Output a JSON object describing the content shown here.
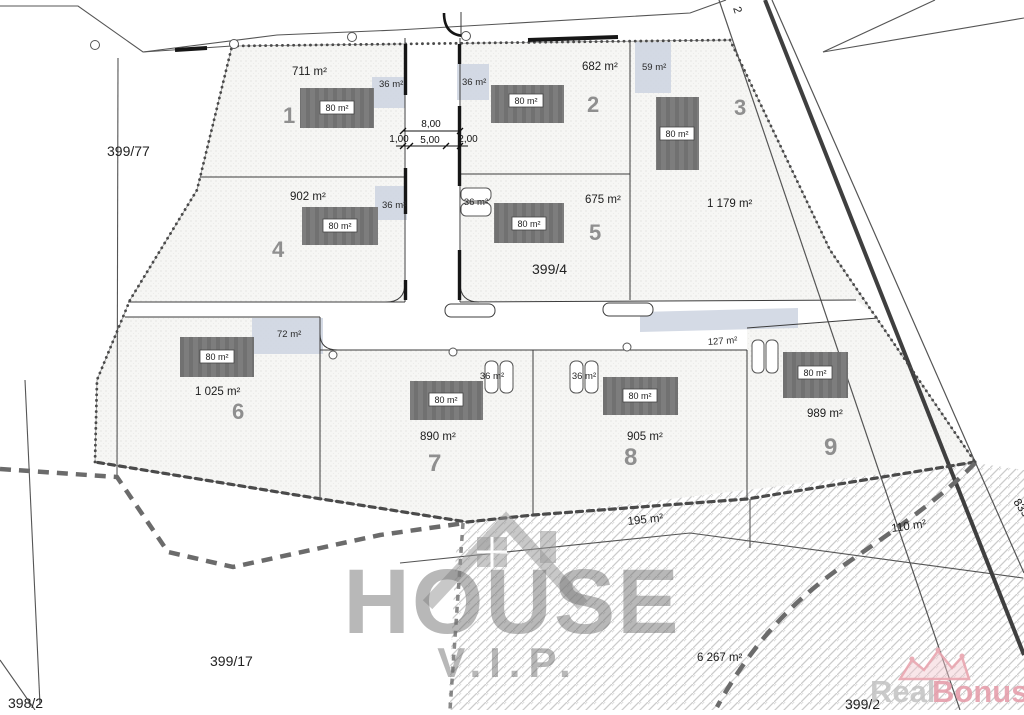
{
  "plan": {
    "plots": [
      {
        "number": "1",
        "area": "711 m²",
        "garage_area": "36 m²",
        "house_area": "80 m²"
      },
      {
        "number": "2",
        "area": "682 m²",
        "garage_area": "36 m²",
        "house_area": "80 m²"
      },
      {
        "number": "3",
        "area": "1 179 m²",
        "garage_area": "59 m²",
        "house_area": "80 m²"
      },
      {
        "number": "4",
        "area": "902 m²",
        "garage_area": "36 m²",
        "house_area": "80 m²"
      },
      {
        "number": "5",
        "area": "675 m²",
        "garage_area": "36 m²",
        "house_area": "80 m²"
      },
      {
        "number": "6",
        "area": "1 025 m²",
        "garage_area": "72 m²",
        "house_area": "80 m²"
      },
      {
        "number": "7",
        "area": "890 m²",
        "garage_area": "36 m²",
        "house_area": "80 m²"
      },
      {
        "number": "8",
        "area": "905 m²",
        "garage_area": "36 m²",
        "house_area": "80 m²"
      },
      {
        "number": "9",
        "area": "989 m²",
        "garage_area": "127 m²",
        "house_area": "80 m²"
      }
    ],
    "parcels": {
      "left": "399/77",
      "central": "399/4",
      "bottom_left": "399/17",
      "corner_bottom_left": "398/2",
      "bottom_partial": "399/2",
      "strip_south": "195 m²",
      "sliver_east": "110 m²",
      "large_south": "6 267 m²"
    },
    "road": {
      "label_east": "835/",
      "label_top": "2",
      "dim_total": "8,00",
      "dim_left": "1,00",
      "dim_mid": "5,00",
      "dim_right": "2,00"
    }
  },
  "watermark": {
    "line1": "HOUSE",
    "line2": "V.I.P."
  },
  "logo": {
    "word1": "Real",
    "word2": "Bonus"
  },
  "colors": {
    "garage": "#ccd3e1",
    "house": "#7b7b7b",
    "hatch": "#cccccc",
    "logo_accent": "#e59aa7",
    "number_gray": "#8f8f8f"
  }
}
